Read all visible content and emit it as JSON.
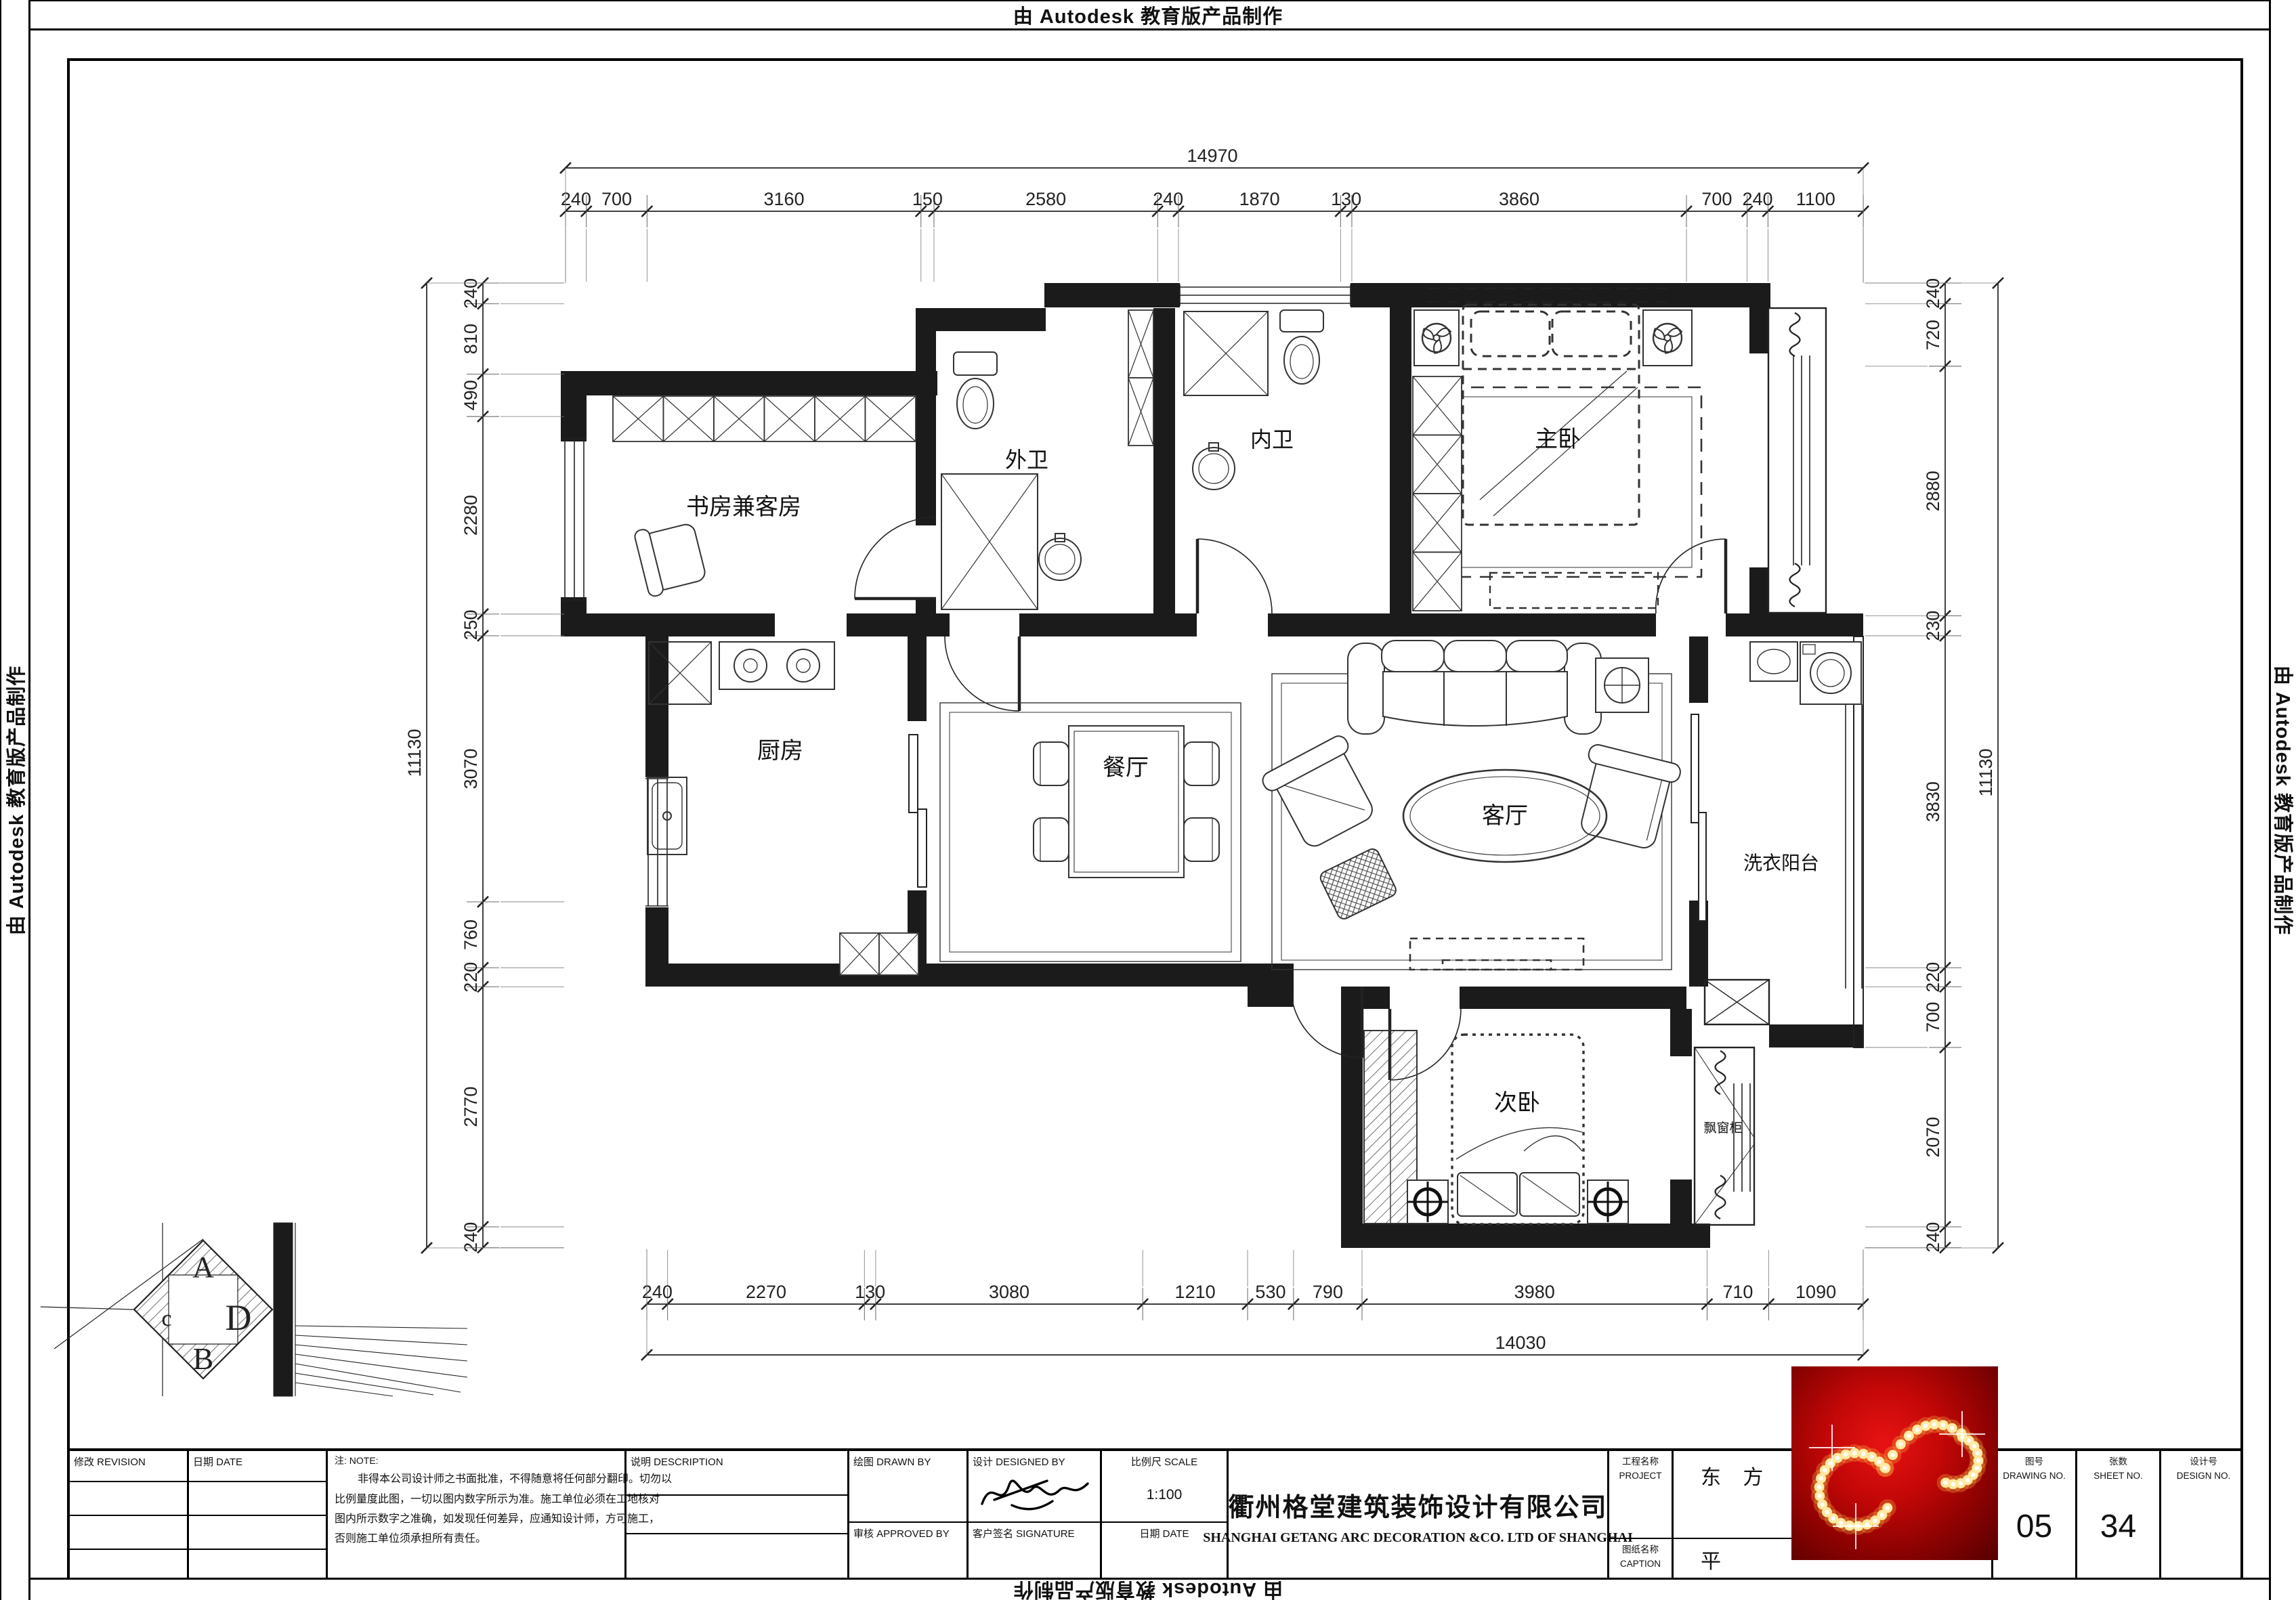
{
  "stamp": "由 Autodesk 教育版产品制作",
  "dimensions": {
    "top": {
      "overall": "14970",
      "segments": [
        "240",
        "700",
        "3160",
        "150",
        "2580",
        "240",
        "1870",
        "130",
        "3860",
        "700",
        "240",
        "1100"
      ]
    },
    "bottom": {
      "overall": "14030",
      "segments": [
        "240",
        "2270",
        "130",
        "3080",
        "1210",
        "530",
        "790",
        "3980",
        "710",
        "1090"
      ]
    },
    "left": {
      "overall": "11130",
      "segments": [
        "240",
        "810",
        "490",
        "2280",
        "250",
        "3070",
        "760",
        "220",
        "2770",
        "240"
      ]
    },
    "right": {
      "overall": "11130",
      "segments": [
        "240",
        "720",
        "2880",
        "230",
        "3830",
        "220",
        "700",
        "2070",
        "240"
      ]
    }
  },
  "rooms": [
    {
      "id": "study",
      "label": "书房兼客房"
    },
    {
      "id": "bath_outer",
      "label": "外卫"
    },
    {
      "id": "bath_inner",
      "label": "内卫"
    },
    {
      "id": "master",
      "label": "主卧"
    },
    {
      "id": "kitchen",
      "label": "厨房"
    },
    {
      "id": "dining",
      "label": "餐厅"
    },
    {
      "id": "living",
      "label": "客厅"
    },
    {
      "id": "laundry",
      "label": "洗衣阳台"
    },
    {
      "id": "second",
      "label": "次卧"
    },
    {
      "id": "bay_cabinet",
      "label": "飘窗柜"
    }
  ],
  "compass": {
    "top": "A",
    "right": "D",
    "bottom": "B",
    "left": "c"
  },
  "titleblock": {
    "revision_label": "修改  REVISION",
    "date_label": "日期  DATE",
    "note_header": "注:  NOTE:",
    "note_lines": [
      "非得本公司设计师之书面批准，不得随意将任何部分翻印。切勿以",
      "比例量度此图，一切以图内数字所示为准。施工单位必须在工地核对",
      "图内所示数字之准确，如发现任何差异，应通知设计师，方可施工，",
      "否则施工单位须承担所有责任。"
    ],
    "description_label": "说明  DESCRIPTION",
    "drawn_label": "绘图  DRAWN BY",
    "designed_label": "设计  DESIGNED BY",
    "scale_label": "比例尺  SCALE",
    "scale_value": "1:100",
    "approved_label": "审核  APPROVED BY",
    "signature_label": "客户签名 SIGNATURE",
    "date2_label": "日期  DATE",
    "company_cn": "衢州格堂建筑装饰设计有限公司",
    "company_en": "SHANGHAI GETANG ARC DECORATION  &CO. LTD OF SHANGHAI",
    "project_label_cn": "工程名称",
    "project_label_en": "PROJECT",
    "project_value": "东 方",
    "caption_label_cn": "图纸名称",
    "caption_label_en": "CAPTION",
    "caption_value": "平",
    "drawing_no_label_cn": "图号",
    "drawing_no_label_en": "DRAWING NO.",
    "drawing_no_value": "05",
    "sheet_label_cn": "张数",
    "sheet_label_en": "SHEET NO.",
    "sheet_value": "34",
    "design_no_label_cn": "设计号",
    "design_no_label_en": "DESIGN NO.",
    "design_no_value": ""
  }
}
